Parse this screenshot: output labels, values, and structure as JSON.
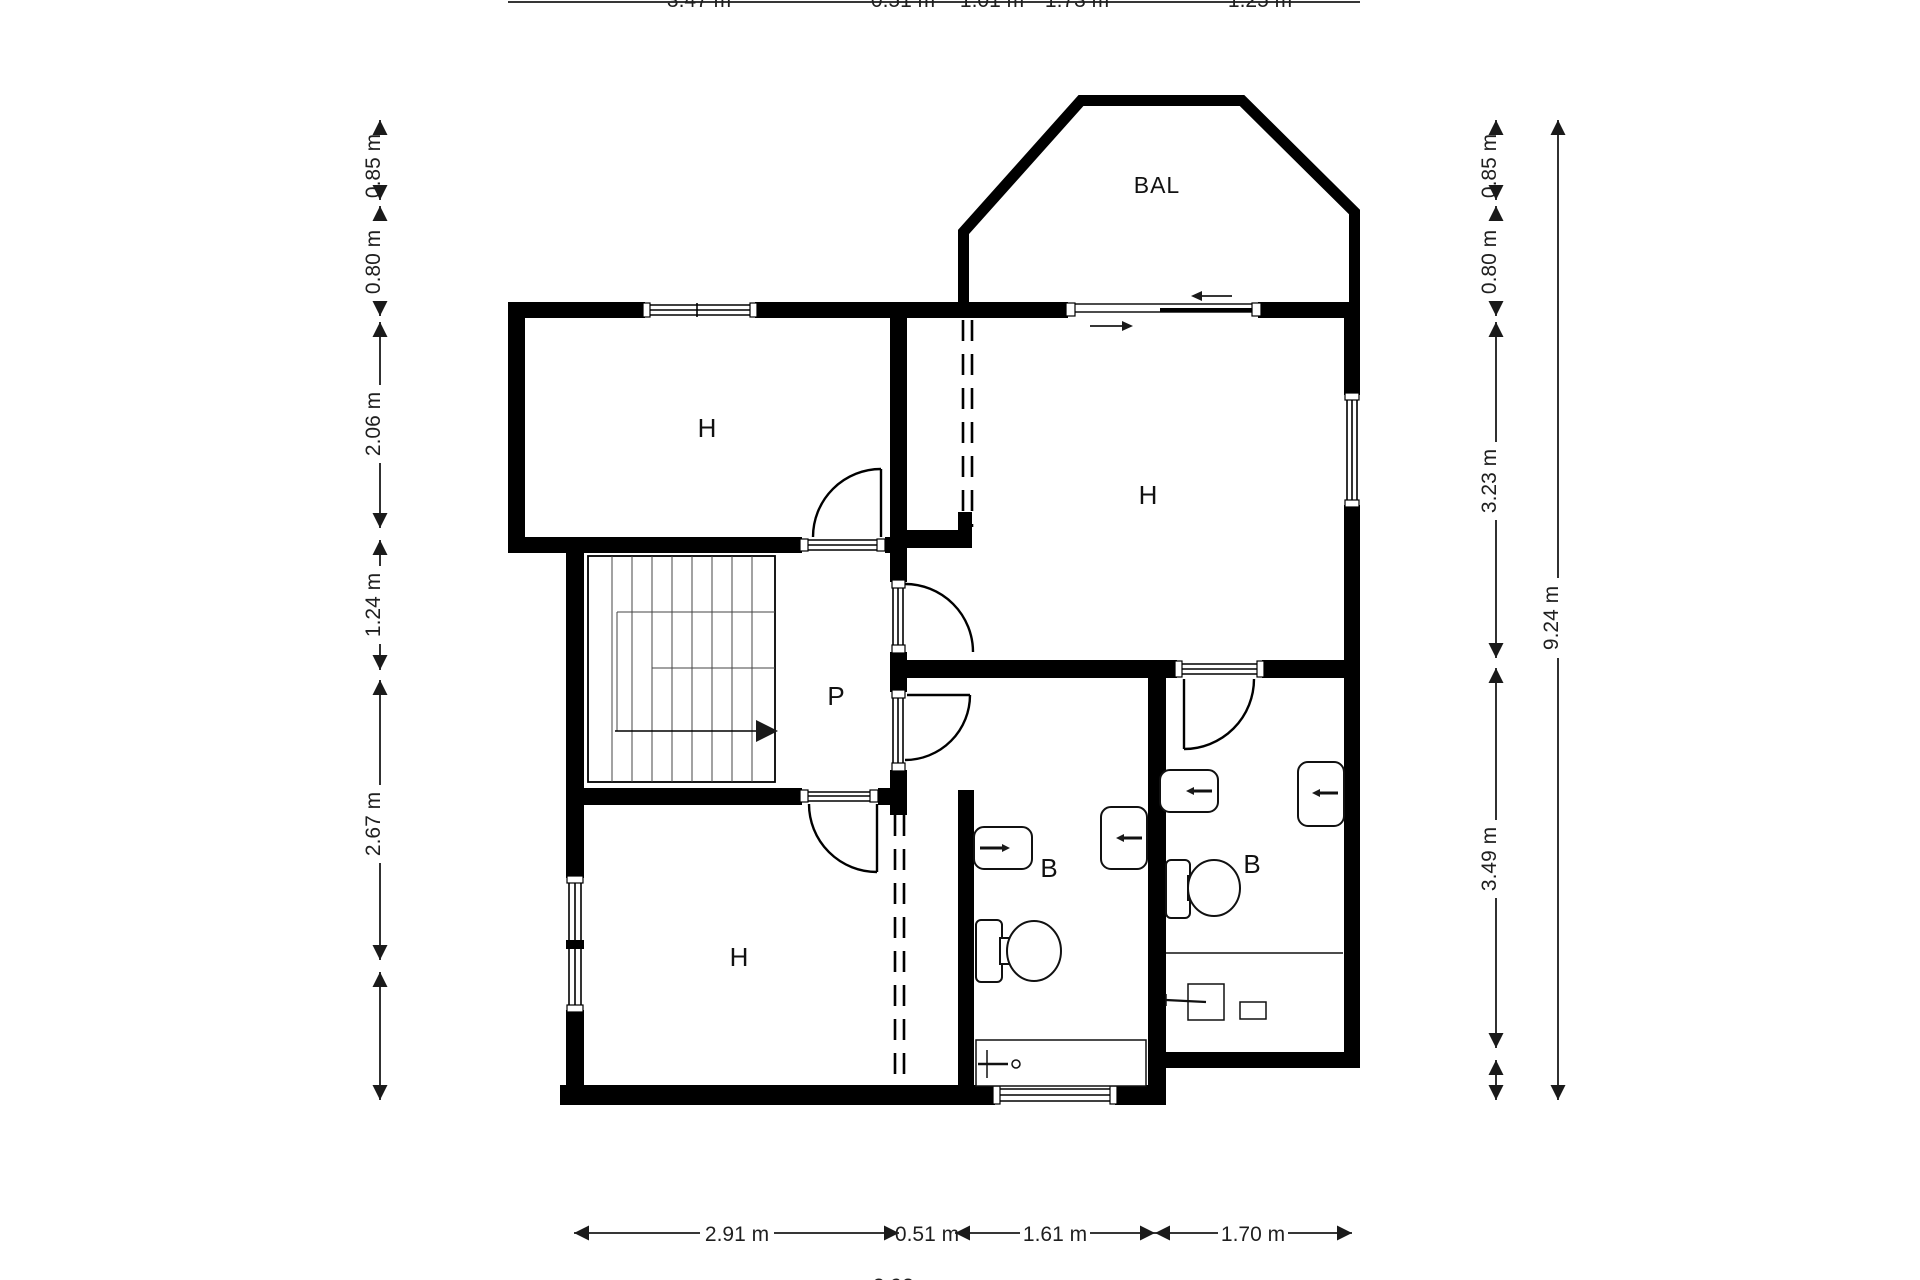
{
  "plan_title": "floor-plan",
  "colors": {
    "wall": "#000000",
    "background": "#ffffff",
    "dimension_text": "#1f1f1f"
  },
  "rooms": {
    "bedroom_top_left": {
      "label": "H"
    },
    "bedroom_right": {
      "label": "H"
    },
    "bedroom_bottom_left": {
      "label": "H"
    },
    "landing": {
      "label": "P"
    },
    "bathroom_center": {
      "label": "B"
    },
    "bathroom_right": {
      "label": "B"
    },
    "balcony": {
      "label": "BAL"
    }
  },
  "dimensions": {
    "left": [
      {
        "label": "0.85 m"
      },
      {
        "label": "0.80 m"
      },
      {
        "label": "2.06 m"
      },
      {
        "label": "1.24 m"
      },
      {
        "label": "2.67 m"
      }
    ],
    "right_inner": [
      {
        "label": "0.85 m"
      },
      {
        "label": "0.80 m"
      },
      {
        "label": "3.23 m"
      },
      {
        "label": "3.49 m"
      }
    ],
    "right_outer": {
      "label": "9.24 m"
    },
    "bottom": [
      {
        "label": "2.91 m"
      },
      {
        "label": "0.51 m"
      },
      {
        "label": "1.61 m"
      },
      {
        "label": "1.70 m"
      }
    ],
    "top_partial": [
      {
        "label": "3.47 m"
      },
      {
        "label": "0.51 m"
      },
      {
        "label": "1.01 m"
      },
      {
        "label": "1.73 m"
      },
      {
        "label": "1.25 m"
      }
    ],
    "bottom_partial": {
      "label": "2.92 m"
    }
  }
}
